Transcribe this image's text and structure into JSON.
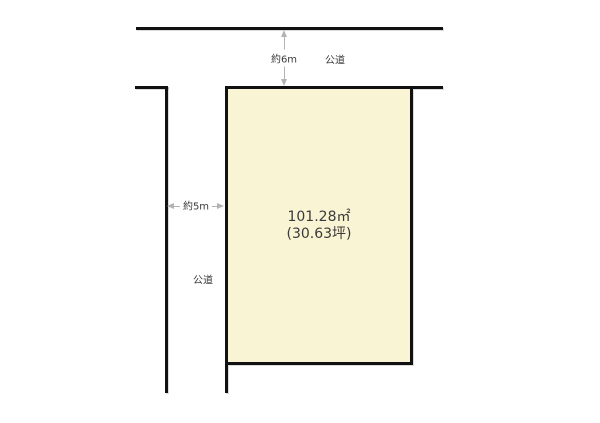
{
  "diagram": {
    "title": "land-plot-site-plan"
  },
  "plot": {
    "area_m2": "101.28㎡",
    "area_tsubo": "(30.63坪)"
  },
  "dimensions": {
    "top_road_width": "約6m",
    "left_road_width": "約5m"
  },
  "labels": {
    "top_road": "公道",
    "left_road": "公道"
  },
  "colors": {
    "plot_fill": "#f9f4d3",
    "line": "#111111",
    "dimension_line": "#b3b3b3",
    "text": "#3a3a3a"
  }
}
